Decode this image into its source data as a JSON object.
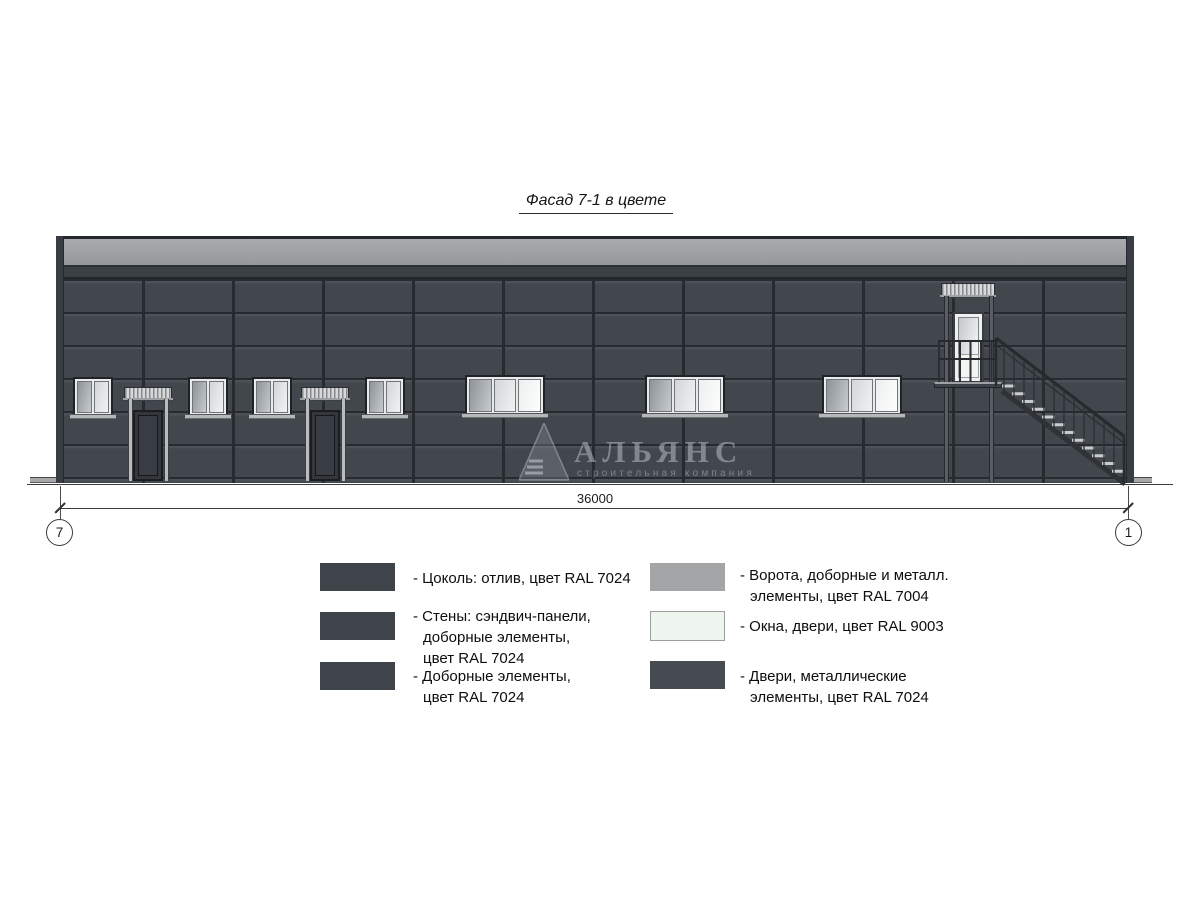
{
  "title": "Фасад 7-1 в цвете",
  "dimension": {
    "value": "36000"
  },
  "axes": {
    "left": "7",
    "right": "1"
  },
  "watermark": {
    "name": "АЛЬЯНС",
    "subtitle": "строительная компания"
  },
  "colors": {
    "wall_ral7024": "#42474e",
    "metal_ral7004": "#a4a5a7",
    "windows_ral9003": "#f0f5f1"
  },
  "legend": {
    "left": [
      {
        "swatch": "#3f444b",
        "lines": [
          "- Цоколь: отлив, цвет RAL 7024"
        ]
      },
      {
        "swatch": "#3f444b",
        "lines": [
          "- Стены: сэндвич-панели,",
          "доборные элементы,",
          "цвет RAL 7024"
        ]
      },
      {
        "swatch": "#3f444b",
        "lines": [
          "- Доборные элементы,",
          "цвет RAL 7024"
        ]
      }
    ],
    "right": [
      {
        "swatch": "#a4a5a7",
        "lines": [
          "- Ворота, доборные и металл.",
          "элементы, цвет RAL 7004"
        ]
      },
      {
        "swatch": "#eef4ee",
        "lines": [
          "- Окна, двери, цвет RAL 9003"
        ]
      },
      {
        "swatch": "#474b52",
        "lines": [
          "- Двери, металлические",
          "элементы, цвет RAL 7024"
        ]
      }
    ]
  }
}
